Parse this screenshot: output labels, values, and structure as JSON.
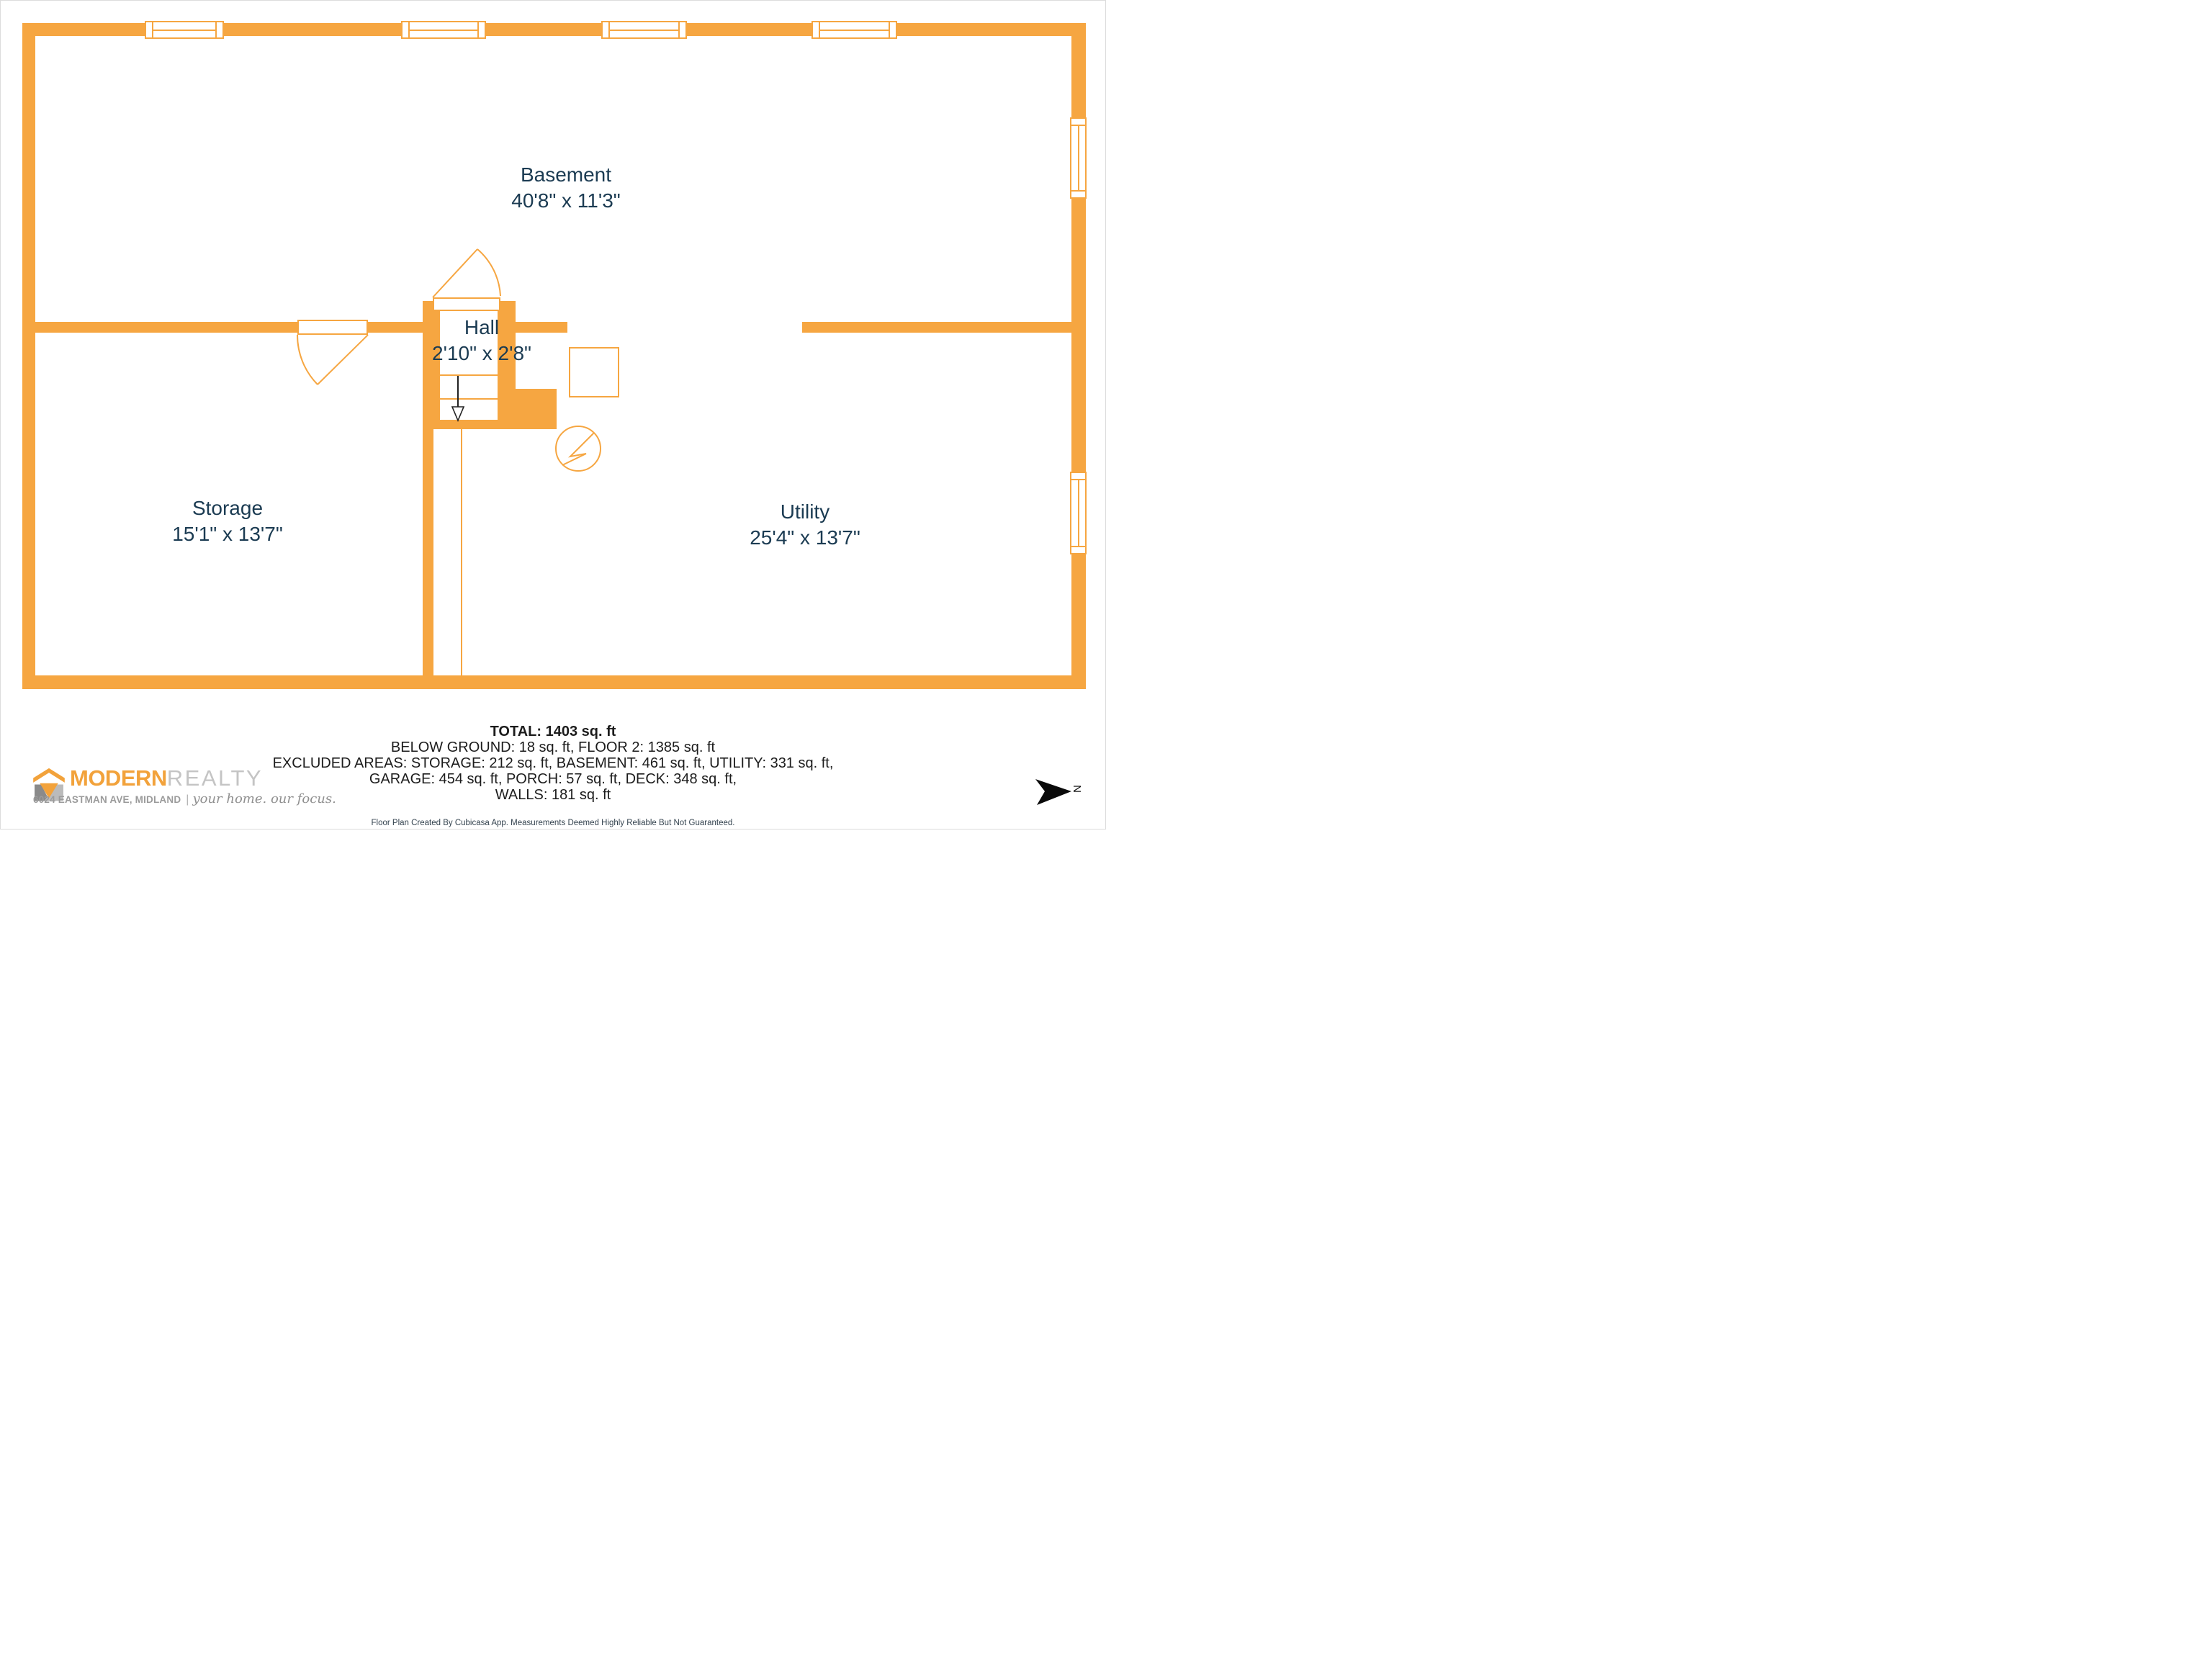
{
  "colors": {
    "wall_orange": "#F6A641",
    "room_text_navy": "#1B3B52",
    "summary_text": "#1C1C1C",
    "logo_orange": "#F2A23B",
    "logo_gray": "#C4C4C4",
    "compass_black": "#111111"
  },
  "rooms": {
    "basement": {
      "name": "Basement",
      "dims": "40'8\" x 11'3\""
    },
    "hall": {
      "name": "Hall",
      "dims": "2'10\" x 2'8\""
    },
    "storage": {
      "name": "Storage",
      "dims": "15'1\" x 13'7\""
    },
    "utility": {
      "name": "Utility",
      "dims": "25'4\" x 13'7\""
    }
  },
  "summary": {
    "total": "TOTAL: 1403 sq. ft",
    "lines": [
      "BELOW GROUND: 18 sq. ft, FLOOR 2: 1385 sq. ft",
      "EXCLUDED AREAS: STORAGE: 212 sq. ft, BASEMENT: 461 sq. ft, UTILITY: 331 sq. ft,",
      "GARAGE: 454 sq. ft, PORCH: 57 sq. ft, DECK: 348 sq. ft,",
      "WALLS: 181 sq. ft"
    ]
  },
  "disclaimer": "Floor Plan Created By Cubicasa App. Measurements Deemed Highly Reliable But Not Guaranteed.",
  "branding": {
    "brand_primary": "MODERN",
    "brand_secondary": "REALTY",
    "address": "6024 EASTMAN AVE, MIDLAND",
    "separator": "|",
    "tagline": "your home. our focus."
  },
  "compass": {
    "north_label": "N"
  }
}
